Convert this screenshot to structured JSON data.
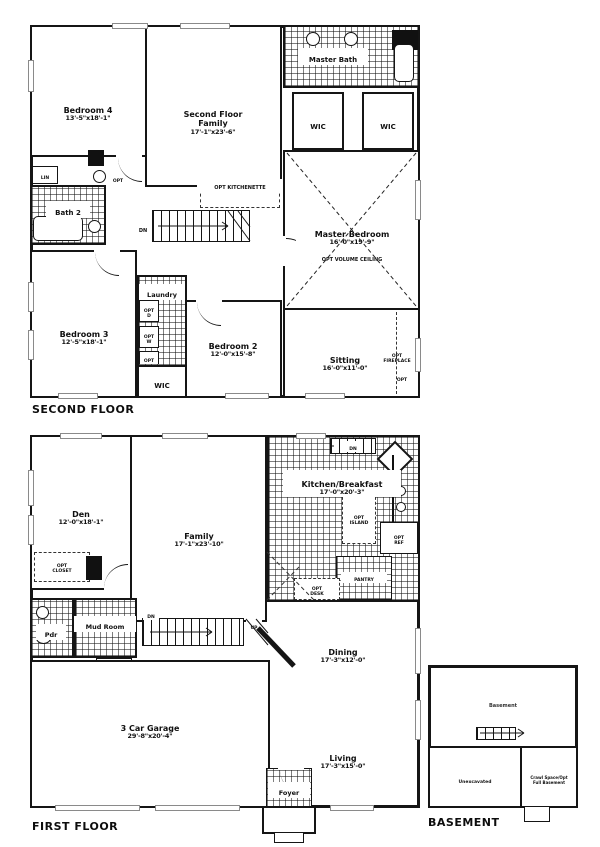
{
  "style": {
    "ink": "#111111",
    "paper": "#ffffff"
  },
  "second_floor": {
    "title": "SECOND FLOOR",
    "rooms": {
      "bedroom4": {
        "name": "Bedroom 4",
        "dims": "13'-5\"x18'-1\""
      },
      "family": {
        "name": "Second Floor\nFamily",
        "dims": "17'-1\"x23'-6\""
      },
      "master_bath": {
        "name": "Master Bath"
      },
      "wic_left": {
        "name": "WIC"
      },
      "wic_right": {
        "name": "WIC"
      },
      "master_bedroom": {
        "name": "Master Bedroom",
        "dims": "16'-0\"x19'-9\"",
        "note": "OPT VOLUME CEILING"
      },
      "sitting": {
        "name": "Sitting",
        "dims": "16'-0\"x11'-0\""
      },
      "bath2": {
        "name": "Bath 2"
      },
      "laundry": {
        "name": "Laundry"
      },
      "bedroom3": {
        "name": "Bedroom 3",
        "dims": "12'-5\"x18'-1\""
      },
      "bedroom2": {
        "name": "Bedroom 2",
        "dims": "12'-0\"x15'-8\""
      },
      "wic_hall": {
        "name": "WIC"
      }
    },
    "annotations": {
      "lin": "LIN",
      "opt_sink": "OPT",
      "opt_kitchenette": "OPT KITCHENETTE",
      "dn": "DN",
      "opt_d": "OPT\nD",
      "opt_w": "OPT\nW",
      "opt_small": "OPT",
      "opt_fireplace": "OPT\nFIREPLACE",
      "opt_corner": "OPT"
    }
  },
  "first_floor": {
    "title": "FIRST FLOOR",
    "rooms": {
      "den": {
        "name": "Den",
        "dims": "12'-0\"x18'-1\""
      },
      "family": {
        "name": "Family",
        "dims": "17'-1\"x23'-10\""
      },
      "kitchen": {
        "name": "Kitchen/Breakfast",
        "dims": "17'-0\"x20'-3\""
      },
      "pdr": {
        "name": "Pdr"
      },
      "mud_room": {
        "name": "Mud Room"
      },
      "dining": {
        "name": "Dining",
        "dims": "17'-3\"x12'-0\""
      },
      "living": {
        "name": "Living",
        "dims": "17'-3\"x15'-0\""
      },
      "foyer": {
        "name": "Foyer"
      },
      "garage": {
        "name": "3 Car Garage",
        "dims": "29'-8\"x20'-4\""
      }
    },
    "annotations": {
      "dn_basement": "DN",
      "opt_island": "OPT\nISLAND",
      "opt_ref": "OPT\nREF",
      "pantry": "PANTRY",
      "opt_desk": "OPT\nDESK",
      "opt_closet": "OPT\nCLOSET",
      "dn": "DN",
      "up": "UP"
    }
  },
  "basement": {
    "title": "BASEMENT",
    "rooms": {
      "main": {
        "name": "Basement"
      },
      "unexcavated": {
        "name": "Unexcavated"
      },
      "crawl": {
        "name": "Crawl Space/Opt\nFull Basement"
      }
    }
  }
}
